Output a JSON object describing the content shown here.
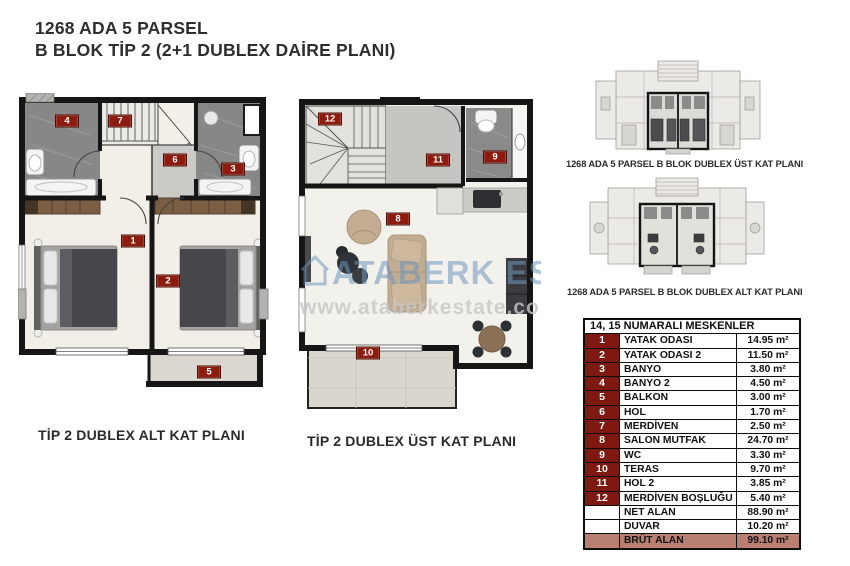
{
  "header": {
    "line1": "1268 ADA 5 PARSEL",
    "line2": "B BLOK TİP 2 (2+1 DUBLEX DAİRE PLANI)"
  },
  "plans": {
    "alt": {
      "caption": "TİP 2 DUBLEX ALT KAT PLANI",
      "badges": [
        "4",
        "7",
        "6",
        "3",
        "1",
        "2",
        "5"
      ]
    },
    "ust": {
      "caption": "TİP 2 DUBLEX ÜST KAT PLANI",
      "badges": [
        "12",
        "11",
        "9",
        "8",
        "10"
      ]
    }
  },
  "overview": {
    "ust_caption": "1268 ADA 5 PARSEL B BLOK DUBLEX ÜST KAT PLANI",
    "alt_caption": "1268 ADA 5 PARSEL B BLOK DUBLEX ALT KAT PLANI"
  },
  "watermark": {
    "brand": "ATABERK ESTATE",
    "url": "www.ataberkestate.com"
  },
  "table": {
    "title": "14, 15  NUMARALI MESKENLER",
    "rows": [
      {
        "num": "1",
        "name": "YATAK ODASI",
        "area": "14.95 m²"
      },
      {
        "num": "2",
        "name": "YATAK ODASI 2",
        "area": "11.50 m²"
      },
      {
        "num": "3",
        "name": "BANYO",
        "area": "3.80 m²"
      },
      {
        "num": "4",
        "name": "BANYO 2",
        "area": "4.50 m²"
      },
      {
        "num": "5",
        "name": "BALKON",
        "area": "3.00 m²"
      },
      {
        "num": "6",
        "name": "HOL",
        "area": "1.70 m²"
      },
      {
        "num": "7",
        "name": "MERDİVEN",
        "area": "2.50 m²"
      },
      {
        "num": "8",
        "name": "SALON MUTFAK",
        "area": "24.70 m²"
      },
      {
        "num": "9",
        "name": "WC",
        "area": "3.30 m²"
      },
      {
        "num": "10",
        "name": "TERAS",
        "area": "9.70 m²"
      },
      {
        "num": "11",
        "name": "HOL 2",
        "area": "3.85 m²"
      },
      {
        "num": "12",
        "name": "MERDİVEN BOŞLUĞU",
        "area": "5.40 m²"
      }
    ],
    "summary": [
      {
        "num": "",
        "name": "NET ALAN",
        "area": "88.90 m²"
      },
      {
        "num": "",
        "name": "DUVAR",
        "area": "10.20 m²"
      }
    ],
    "total": {
      "num": "",
      "name": "BRÜT ALAN",
      "area": "99.10 m²"
    }
  },
  "colors": {
    "badge": "#8C1B10",
    "table_number_bg": "#7E1911",
    "brut_row_bg": "#B97F72",
    "wall": "#161616",
    "watermark_blue": "#6E96BC"
  }
}
